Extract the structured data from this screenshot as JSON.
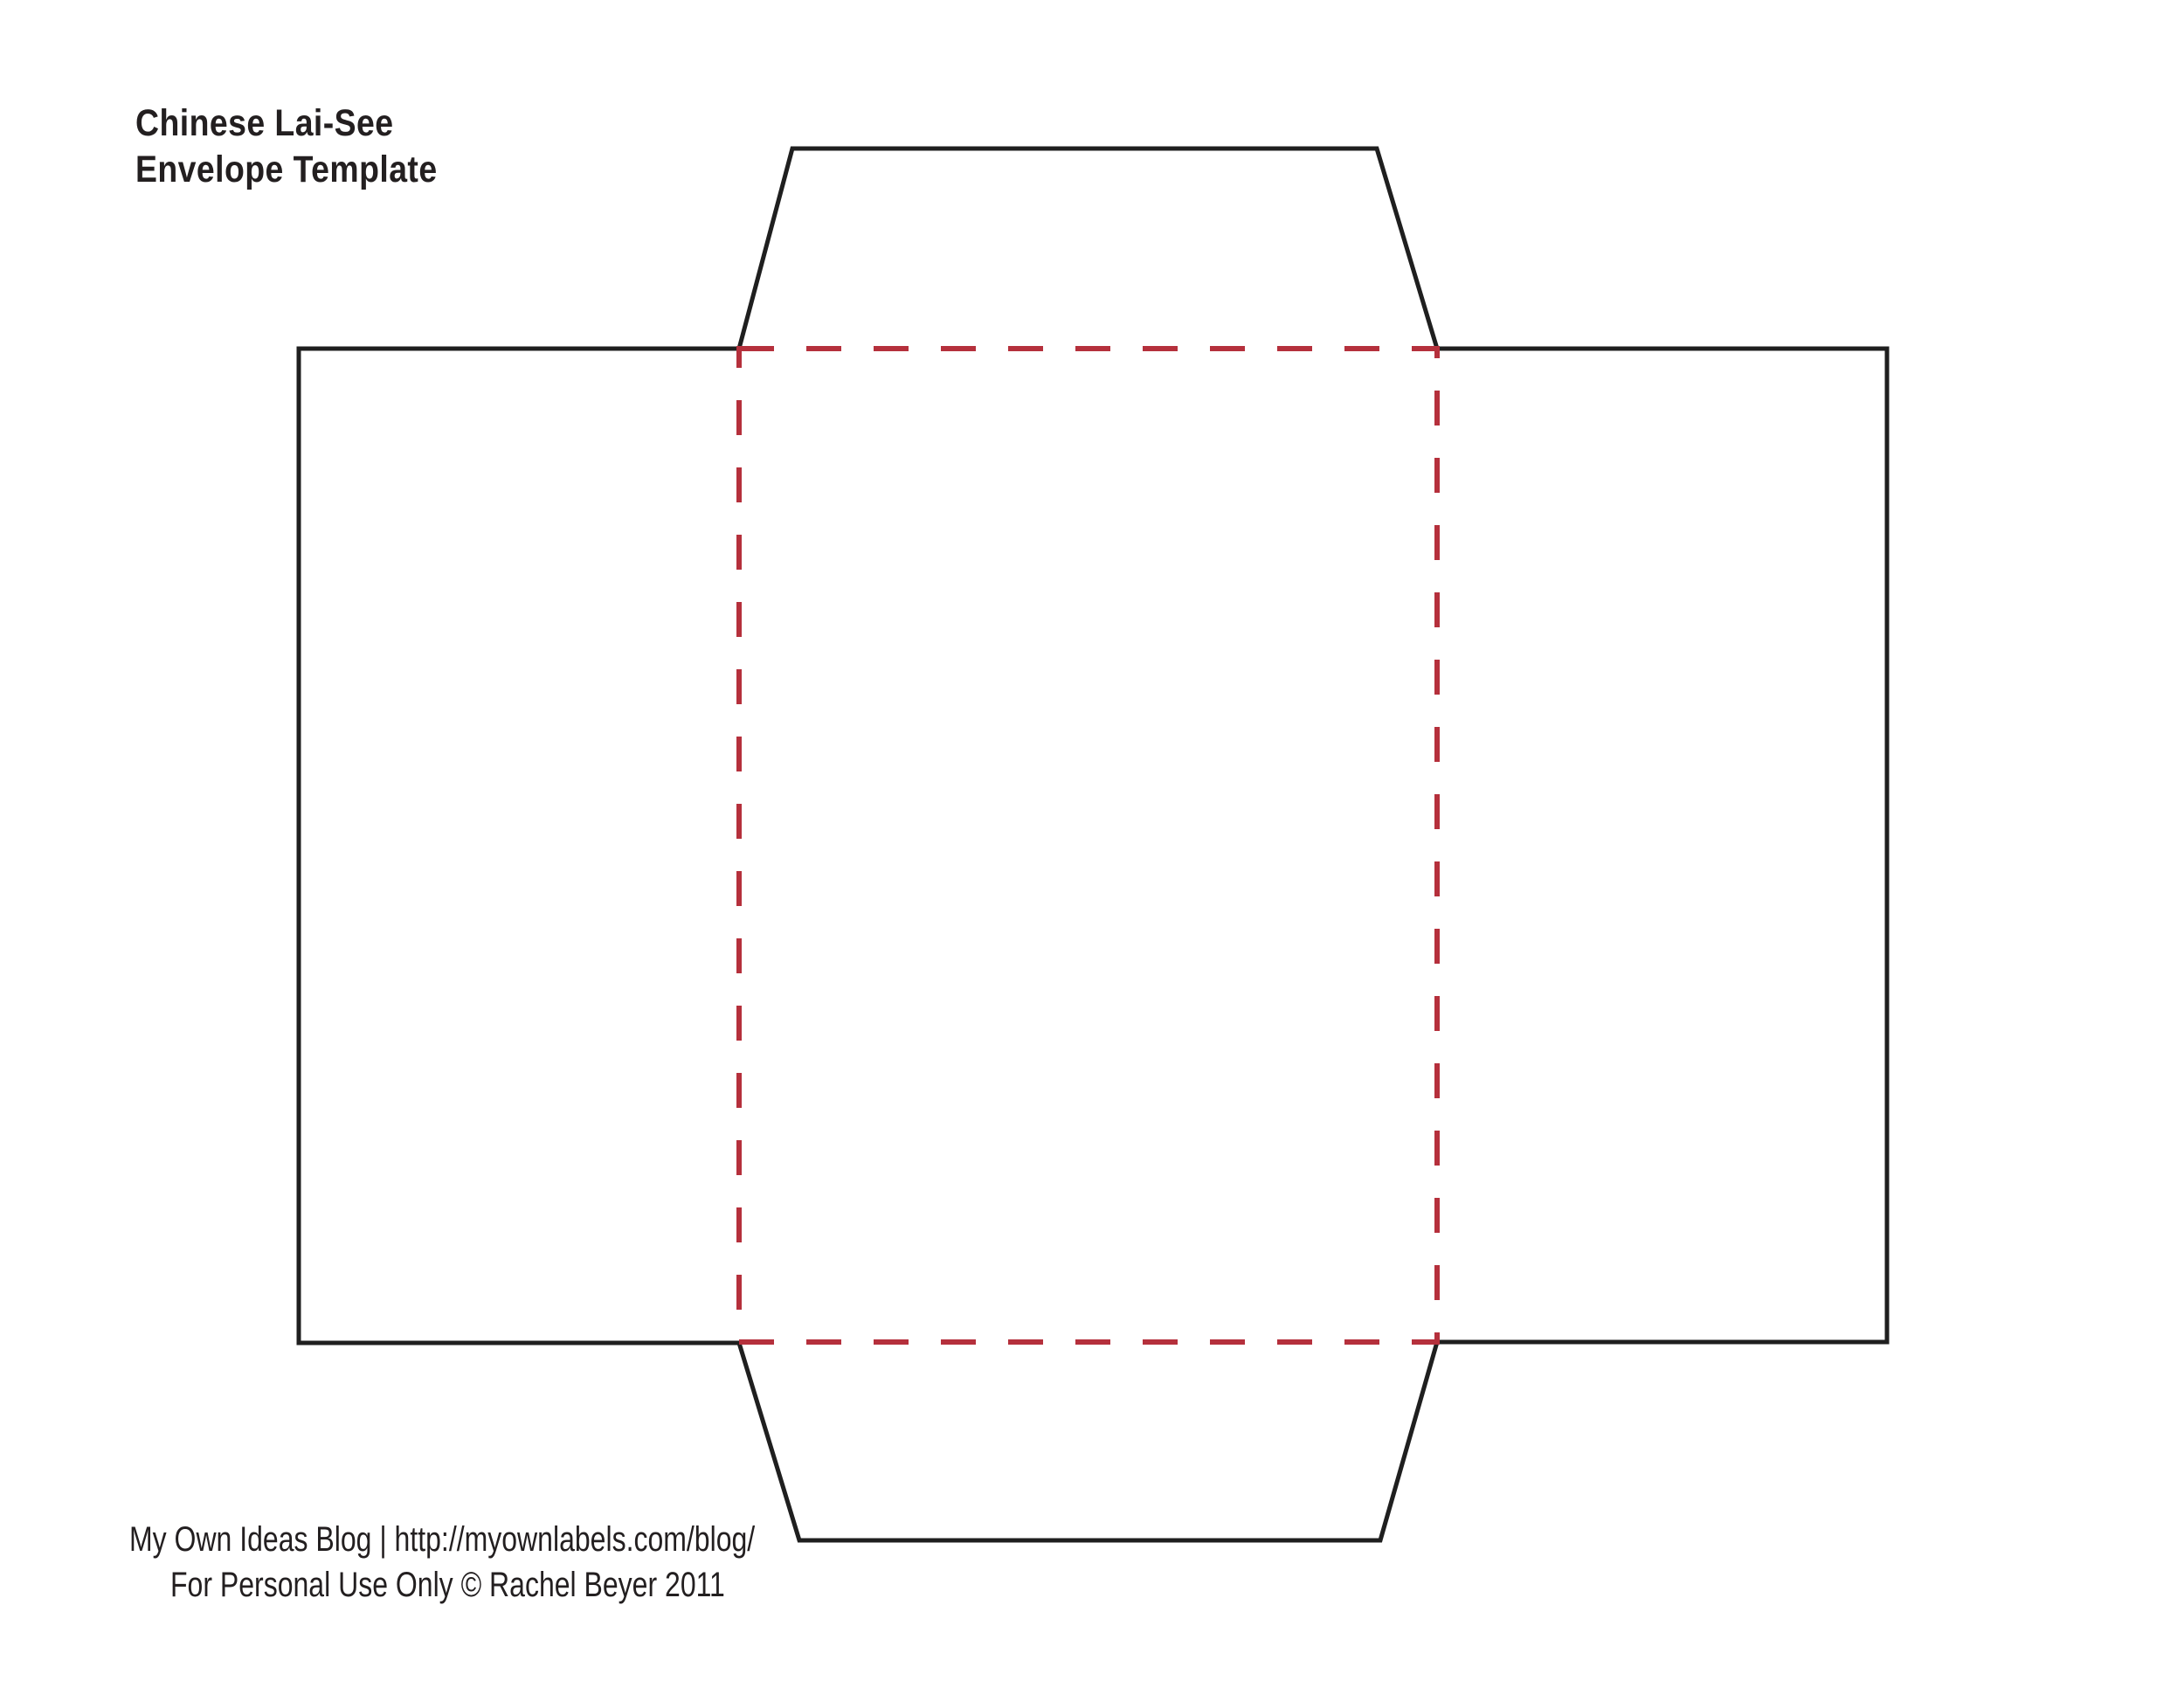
{
  "header": {
    "title_line1": "Chinese Lai-See",
    "title_line2": "Envelope Template"
  },
  "footer": {
    "credit_line": "My Own Ideas Blog | http://myownlabels.com/blog/",
    "license_line": "For Personal Use Only © Rachel Beyer 2011"
  },
  "colors": {
    "cut_line": "#1f1f1f",
    "fold_line": "#b5303c",
    "text": "#231f20"
  }
}
